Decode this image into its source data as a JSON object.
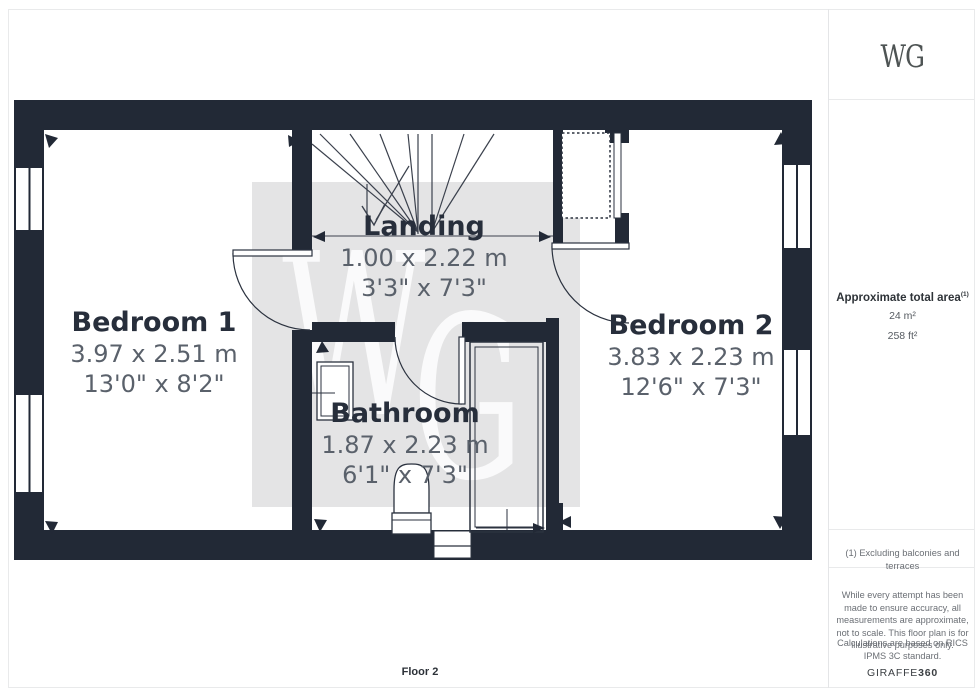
{
  "plan": {
    "floor_label": "Floor 2",
    "watermark": {
      "letter_w": "W",
      "letter_g": "G"
    },
    "rooms": {
      "bedroom1": {
        "name": "Bedroom 1",
        "metric": "3.97 x 2.51 m",
        "imperial": "13'0\" x 8'2\""
      },
      "landing": {
        "name": "Landing",
        "metric": "1.00 x 2.22 m",
        "imperial": "3'3\" x 7'3\""
      },
      "bathroom": {
        "name": "Bathroom",
        "metric": "1.87 x 2.23 m",
        "imperial": "6'1\" x 7'3\""
      },
      "bedroom2": {
        "name": "Bedroom 2",
        "metric": "3.83 x 2.23 m",
        "imperial": "12'6\" x 7'3\""
      }
    }
  },
  "sidebar": {
    "logo": "WG",
    "area_title": "Approximate total area",
    "area_superscript": "(1)",
    "area_metric": "24 m²",
    "area_imperial": "258 ft²",
    "footnote": "(1) Excluding balconies and terraces",
    "disclaimer": "While every attempt has been made to ensure accuracy, all measurements are approximate, not to scale. This floor plan is for illustrative purposes only.",
    "standard_note": "Calculations are based on RICS IPMS 3C standard.",
    "brand_name": "GIRAFFE",
    "brand_suffix": "360"
  },
  "colors": {
    "wall": "#222936",
    "line": "#2b323f",
    "watermark_bg": "#e4e4e5",
    "room_name_text": "#272e3b",
    "room_dim_text": "#5a616b"
  }
}
